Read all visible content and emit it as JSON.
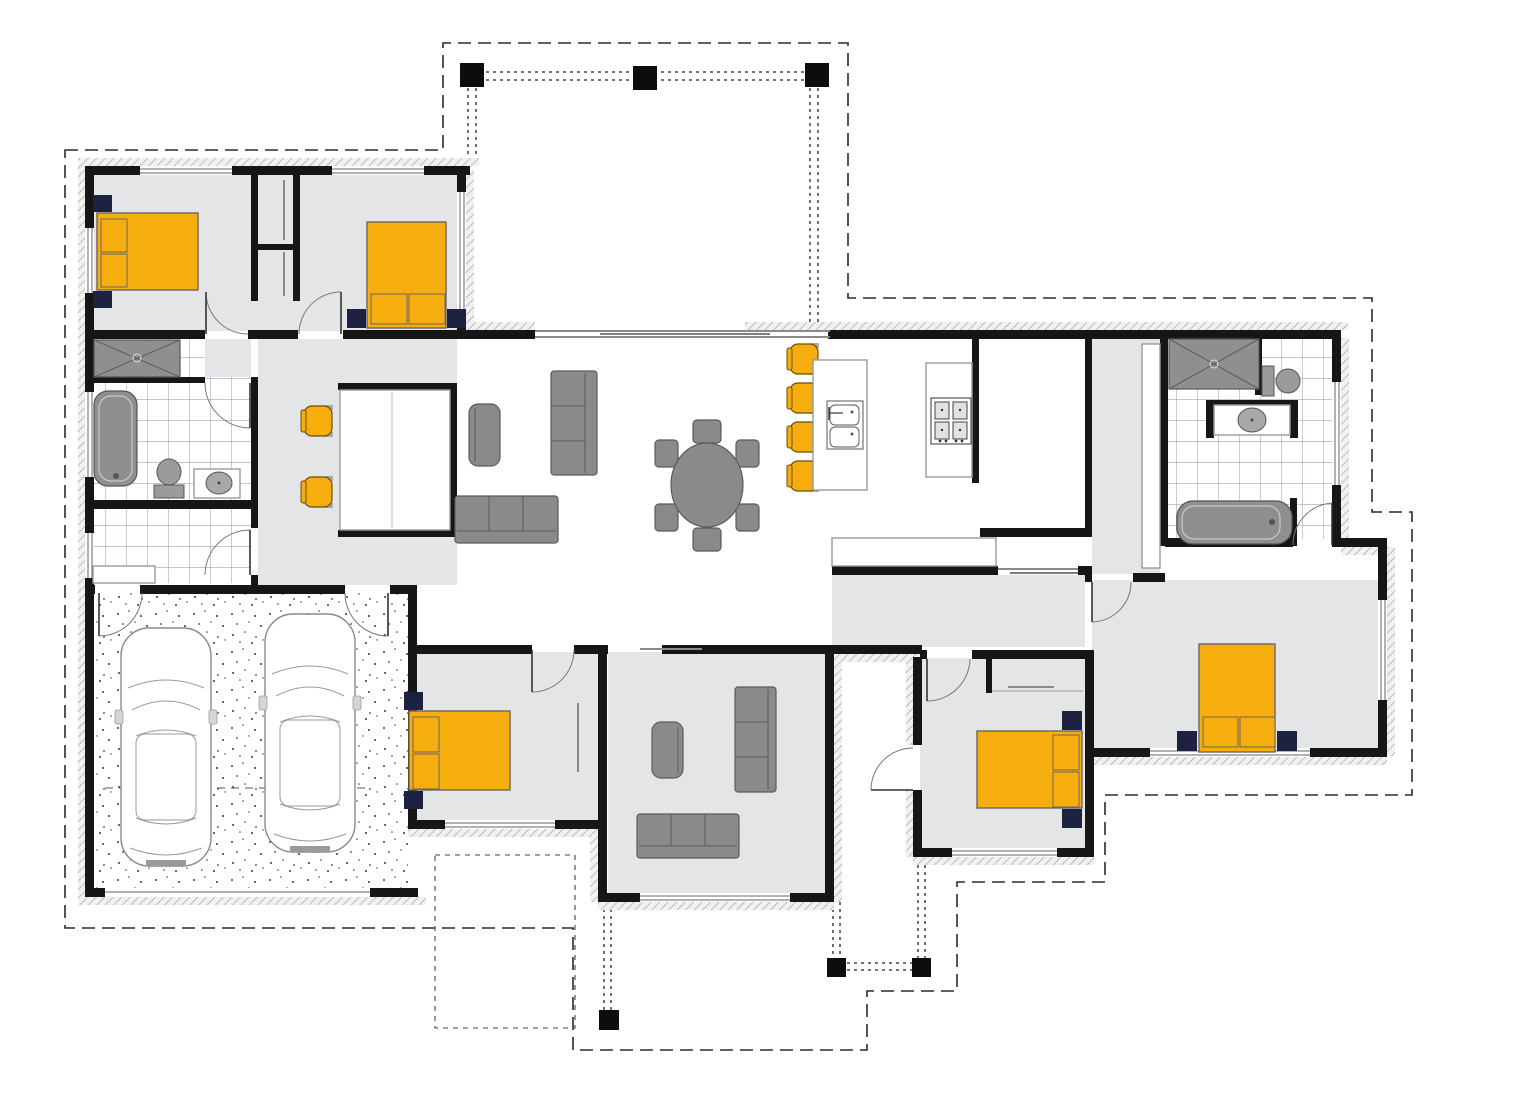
{
  "title": "single-storey house floor plan",
  "colors": {
    "accent": "#F6AE0F",
    "navy": "#1C2240",
    "wall": "#161616",
    "floor": "#E4E5E7",
    "furn": "#8A8A8A",
    "fixture": "#8F8F8F",
    "tile": "#6E7A99",
    "outline": "#2B2B2B",
    "benchline": "#999999",
    "white": "#FFFFFF"
  },
  "counts": {
    "bedrooms": 5,
    "beds": 5,
    "cars": 2,
    "bar_stools": 4,
    "desk_chairs": 2,
    "dining_chairs": 6,
    "sofas": 4,
    "armchairs": 2,
    "showers": 2,
    "bathtubs": 2,
    "toilets": 2,
    "vanities": 2,
    "pergola_posts": 6,
    "door_swings": 11
  },
  "rooms": [
    {
      "id": "garage",
      "label": "double garage",
      "items": [
        "car",
        "car",
        "garage-door"
      ]
    },
    {
      "id": "laundry",
      "label": "laundry",
      "items": [
        "bench",
        "tiled-floor"
      ]
    },
    {
      "id": "bathroom",
      "label": "bathroom",
      "items": [
        "shower",
        "bathtub",
        "toilet",
        "vanity"
      ]
    },
    {
      "id": "bedroom-1",
      "label": "bedroom 1",
      "items": [
        "double-bed",
        "nightstand",
        "nightstand",
        "wardrobe"
      ]
    },
    {
      "id": "bedroom-2",
      "label": "bedroom 2",
      "items": [
        "double-bed",
        "nightstand",
        "nightstand",
        "wardrobe"
      ]
    },
    {
      "id": "study-nook",
      "label": "study nook",
      "items": [
        "desk",
        "chair",
        "chair"
      ]
    },
    {
      "id": "living-room",
      "label": "living room",
      "items": [
        "armchair",
        "sofa",
        "sofa"
      ]
    },
    {
      "id": "dining-area",
      "label": "dining area",
      "items": [
        "oval-table",
        "chair",
        "chair",
        "chair",
        "chair",
        "chair",
        "chair"
      ]
    },
    {
      "id": "kitchen",
      "label": "kitchen",
      "items": [
        "island-bench",
        "double-sink",
        "cooktop",
        "stool",
        "stool",
        "stool",
        "stool"
      ]
    },
    {
      "id": "pantry",
      "label": "pantry",
      "items": []
    },
    {
      "id": "rear-hallway",
      "label": "hallway",
      "items": [
        "bench",
        "cavity-slider"
      ]
    },
    {
      "id": "lounge-room",
      "label": "lounge / media",
      "items": [
        "armchair",
        "sofa",
        "sofa"
      ]
    },
    {
      "id": "bedroom-3",
      "label": "bedroom 3",
      "items": [
        "double-bed",
        "nightstand",
        "nightstand",
        "wardrobe"
      ]
    },
    {
      "id": "bedroom-4",
      "label": "bedroom 4",
      "items": [
        "double-bed",
        "nightstand",
        "nightstand",
        "wardrobe",
        "external-door"
      ]
    },
    {
      "id": "master-bedroom",
      "label": "master bedroom",
      "items": [
        "double-bed",
        "nightstand",
        "nightstand"
      ]
    },
    {
      "id": "walk-in-robe",
      "label": "walk-in robe",
      "items": [
        "shelving"
      ]
    },
    {
      "id": "ensuite",
      "label": "ensuite",
      "items": [
        "shower",
        "toilet",
        "vanity",
        "bathtub"
      ]
    },
    {
      "id": "porch",
      "label": "porch / alfresco",
      "items": [
        "posts",
        "roof-overhang"
      ]
    }
  ]
}
